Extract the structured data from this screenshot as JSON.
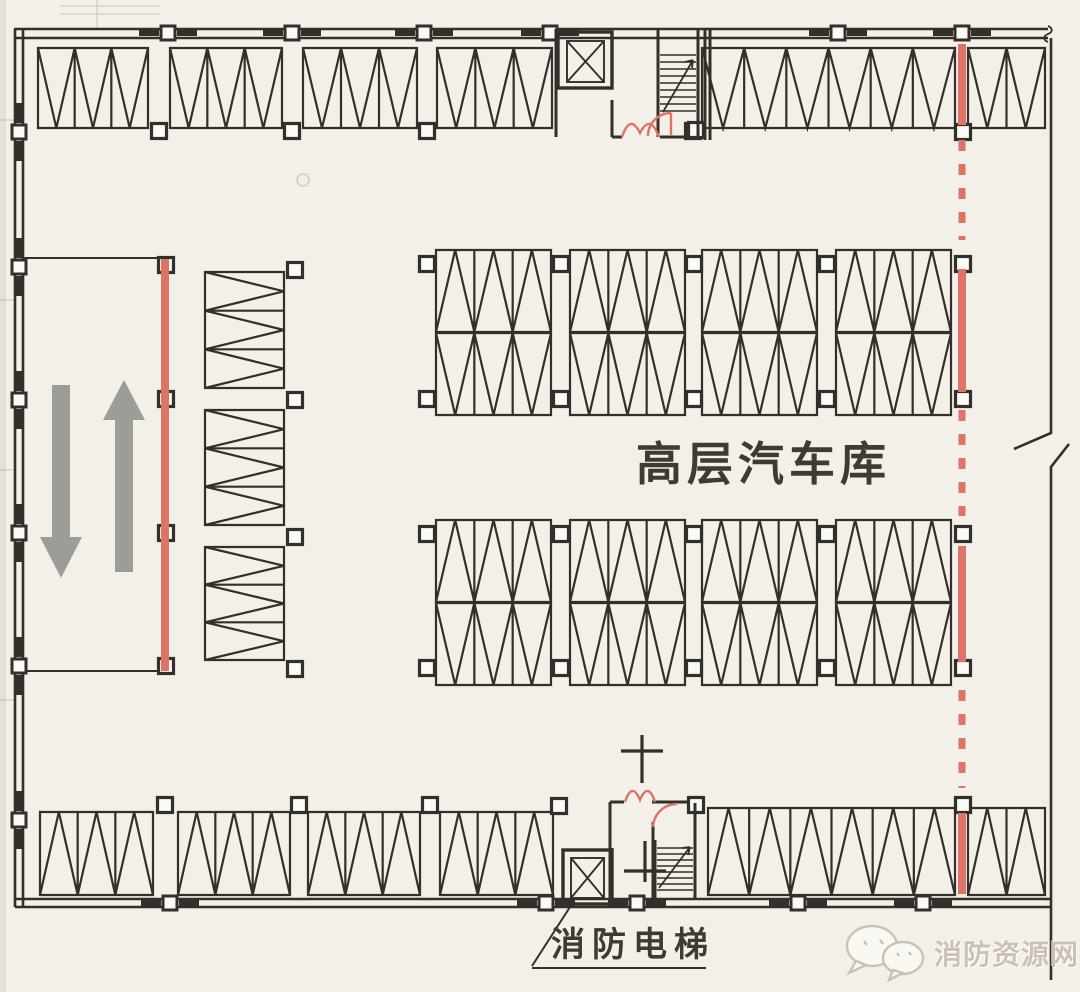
{
  "document": {
    "type": "architectural-floor-plan",
    "title_label": "高层汽车库",
    "callout_label": "消防电梯",
    "watermark": {
      "text": "消防资源网",
      "icon": "wechat-chat-bubbles-icon"
    }
  },
  "icons": {
    "elevator": "box-with-x-elevator-icon",
    "stairs": "stair-treads-with-arrow-icon",
    "fire_doors": "red-door-swing-arc-icon",
    "ramp_up": "up-arrow-icon",
    "ramp_down": "down-arrow-icon",
    "standpipe": "cross-marker-icon",
    "watermark_logo": "wechat-chat-bubbles-icon"
  },
  "colors": {
    "paper": "#f3f0e9",
    "ink": "#332f2a",
    "fire_shutter_red": "#de7366",
    "arrow_gray": "#9d9c97",
    "label_dark": "#3f3b34",
    "watermark_gray": "#cbc1b6"
  }
}
